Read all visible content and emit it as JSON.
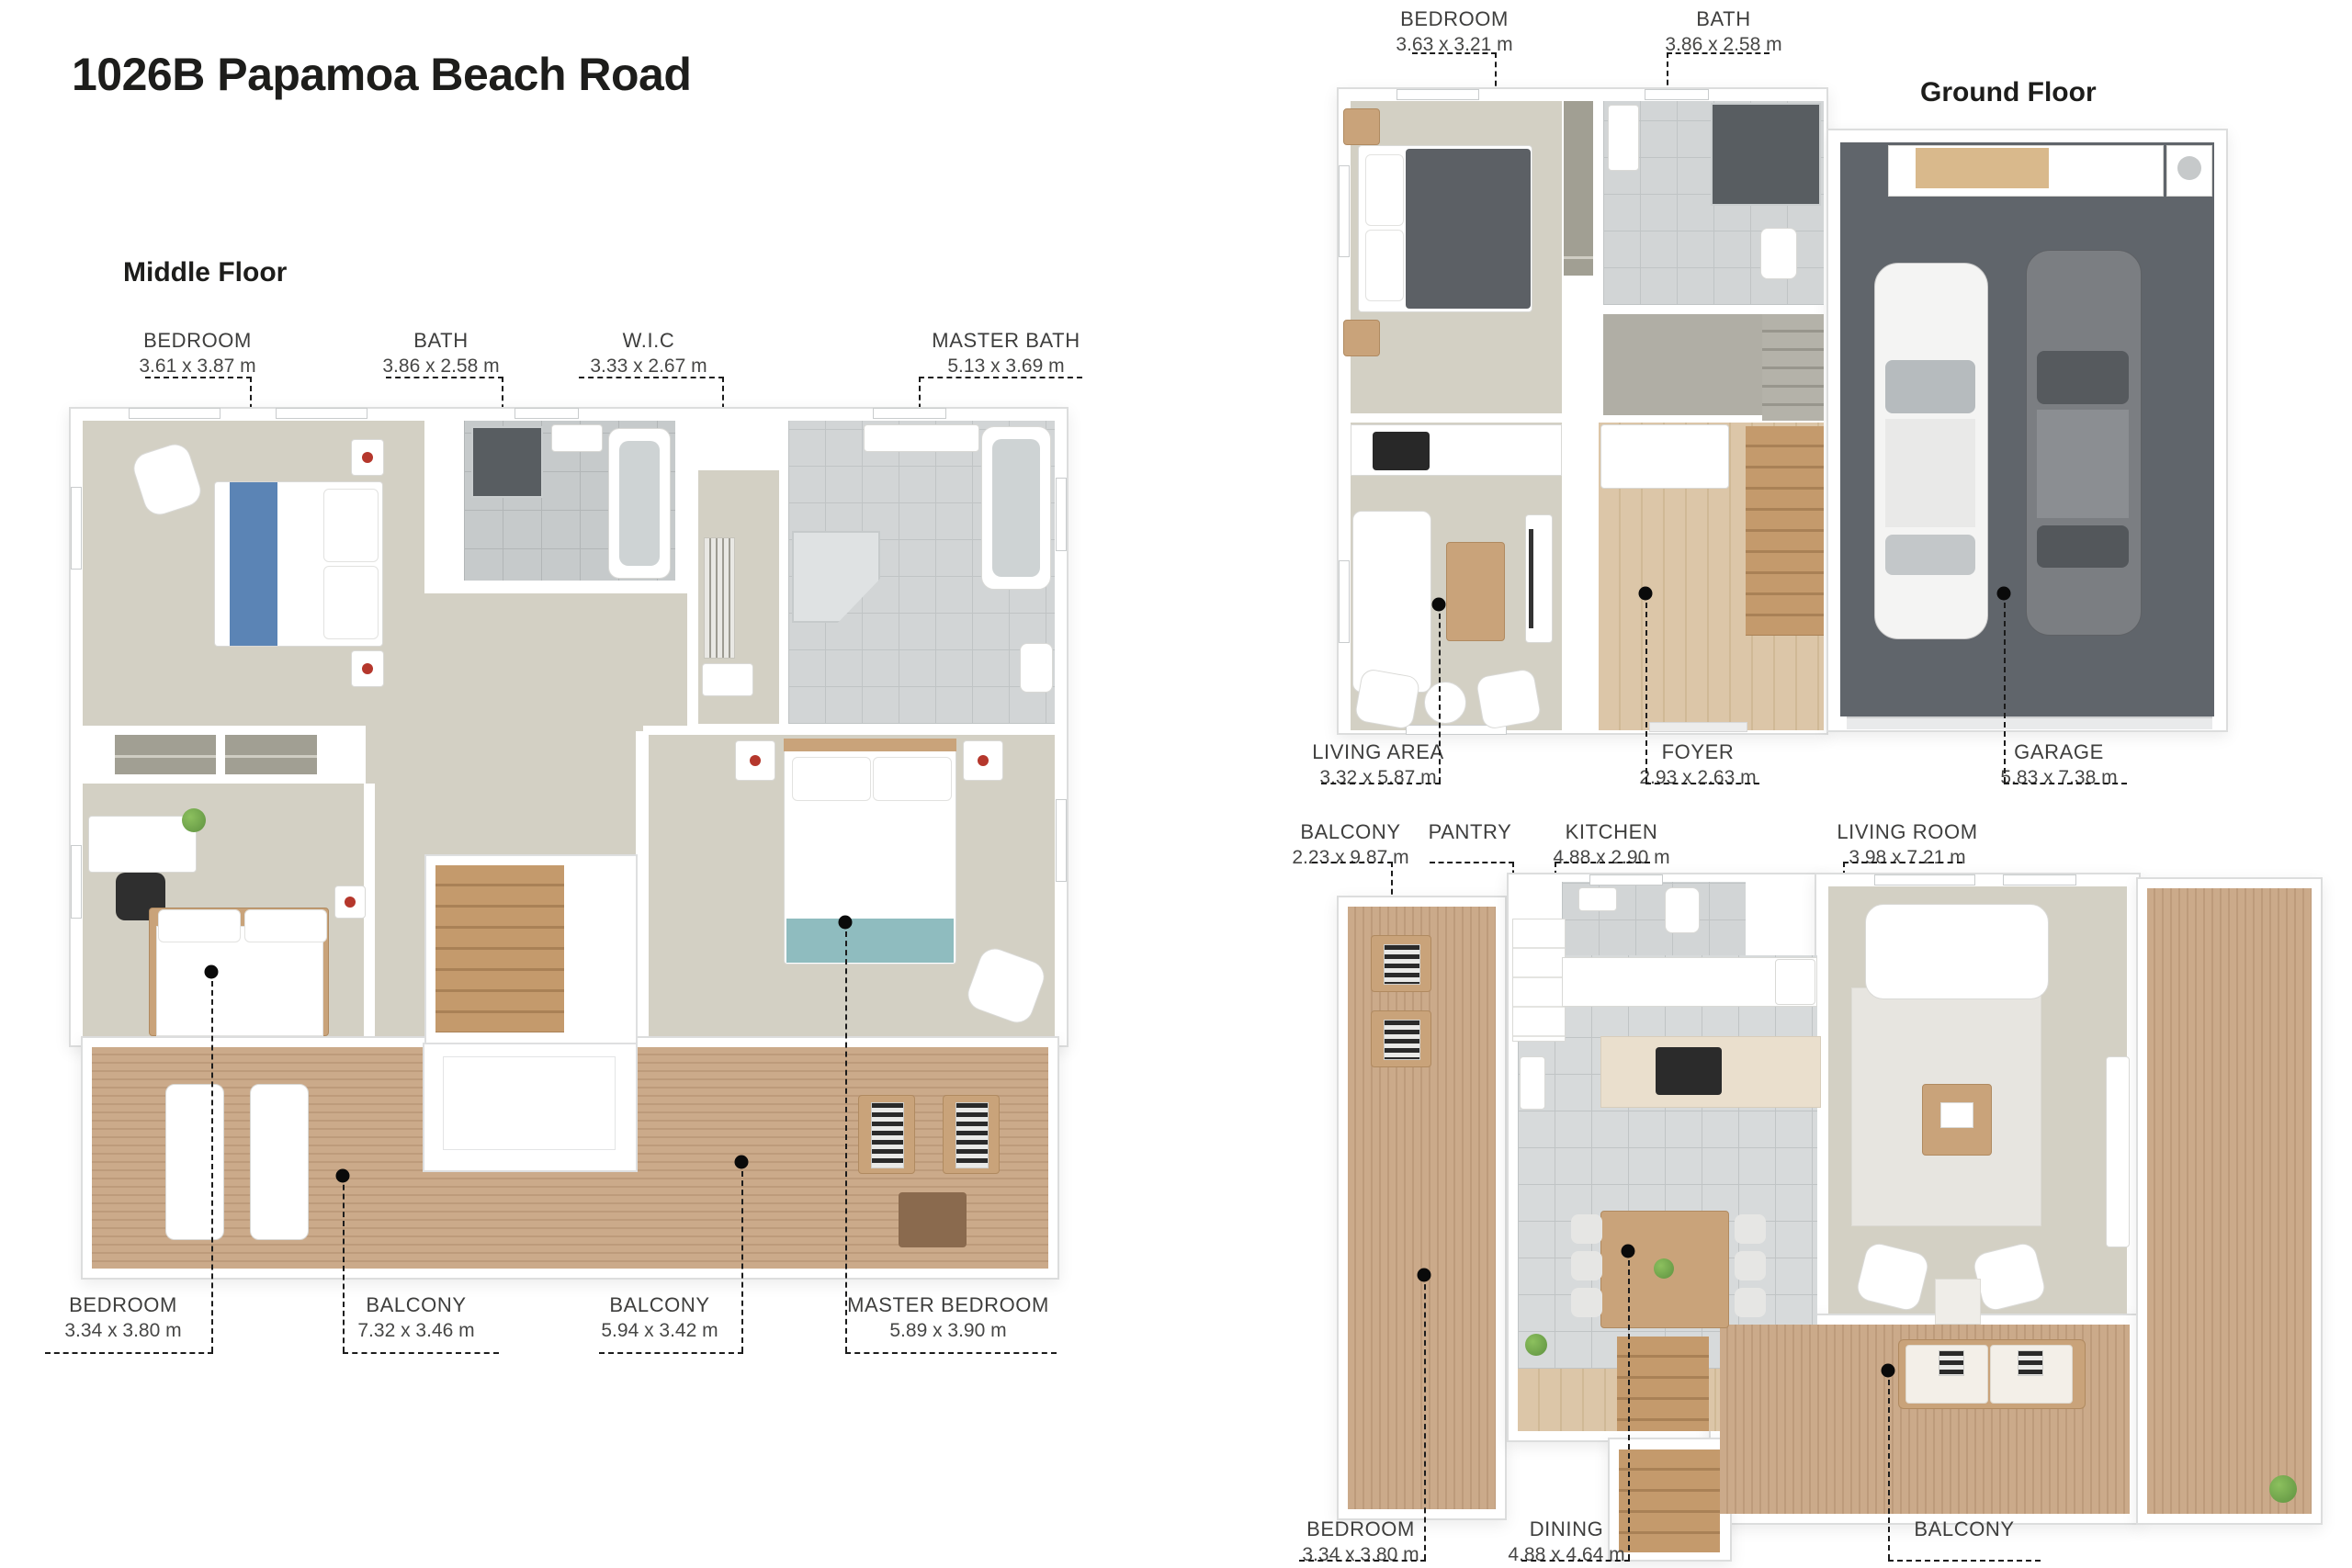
{
  "title": "1026B Papamoa Beach Road",
  "palette": {
    "ink": "#1d1d1b",
    "label": "#3e3e3d",
    "wall-edge": "#dcdddd",
    "carpet": "#d3d0c4",
    "carpet2": "#b0aea5",
    "tile": "#c6cacb",
    "tile-line": "#b2b6b7",
    "tile-light": "#d2d5d6",
    "deck": "#cbaa8a",
    "deck-line": "#bd9b7b",
    "wood-floor": "#dcc6a8",
    "stair-wood": "#c49a6c",
    "garage": "#60656b",
    "shower-dark": "#585d61",
    "wood-furn": "#c9a37a",
    "bed-blue": "#5b84b5",
    "bed-teal": "#8fbcbf",
    "duvet-dark": "#5c6065",
    "plant": "#5e9140"
  },
  "floors": {
    "middle": {
      "heading": "Middle Floor",
      "rooms_top": [
        {
          "name": "BEDROOM",
          "dims": "3.61 x 3.87 m"
        },
        {
          "name": "BATH",
          "dims": "3.86 x 2.58 m"
        },
        {
          "name": "W.I.C",
          "dims": "3.33 x 2.67 m"
        },
        {
          "name": "MASTER BATH",
          "dims": "5.13 x 3.69 m"
        }
      ],
      "rooms_bottom": [
        {
          "name": "BEDROOM",
          "dims": "3.34 x 3.80 m"
        },
        {
          "name": "BALCONY",
          "dims": "7.32 x 3.46 m"
        },
        {
          "name": "BALCONY",
          "dims": "5.94 x 3.42 m"
        },
        {
          "name": "MASTER BEDROOM",
          "dims": "5.89 x 3.90 m"
        }
      ]
    },
    "ground": {
      "heading": "Ground Floor",
      "rooms_top": [
        {
          "name": "BEDROOM",
          "dims": "3.63 x 3.21 m"
        },
        {
          "name": "BATH",
          "dims": "3.86 x 2.58 m"
        }
      ],
      "rooms_bottom": [
        {
          "name": "LIVING AREA",
          "dims": "3.32 x 5.87 m"
        },
        {
          "name": "FOYER",
          "dims": "2.93 x 2.63 m"
        },
        {
          "name": "GARAGE",
          "dims": "5.83 x 7.38 m"
        }
      ]
    },
    "top": {
      "heading": "Top Floor",
      "rooms_top": [
        {
          "name": "BALCONY",
          "dims": "2.23 x 9.87 m"
        },
        {
          "name": "PANTRY",
          "dims": ""
        },
        {
          "name": "KITCHEN",
          "dims": "4.88 x 2.90 m"
        },
        {
          "name": "LIVING ROOM",
          "dims": "3.98 x 7.21 m"
        }
      ],
      "rooms_bottom": [
        {
          "name": "BEDROOM",
          "dims": "3.34 x 3.80 m"
        },
        {
          "name": "DINING",
          "dims": "4.88 x 4.64 m"
        },
        {
          "name": "BALCONY",
          "dims": ""
        }
      ]
    }
  }
}
